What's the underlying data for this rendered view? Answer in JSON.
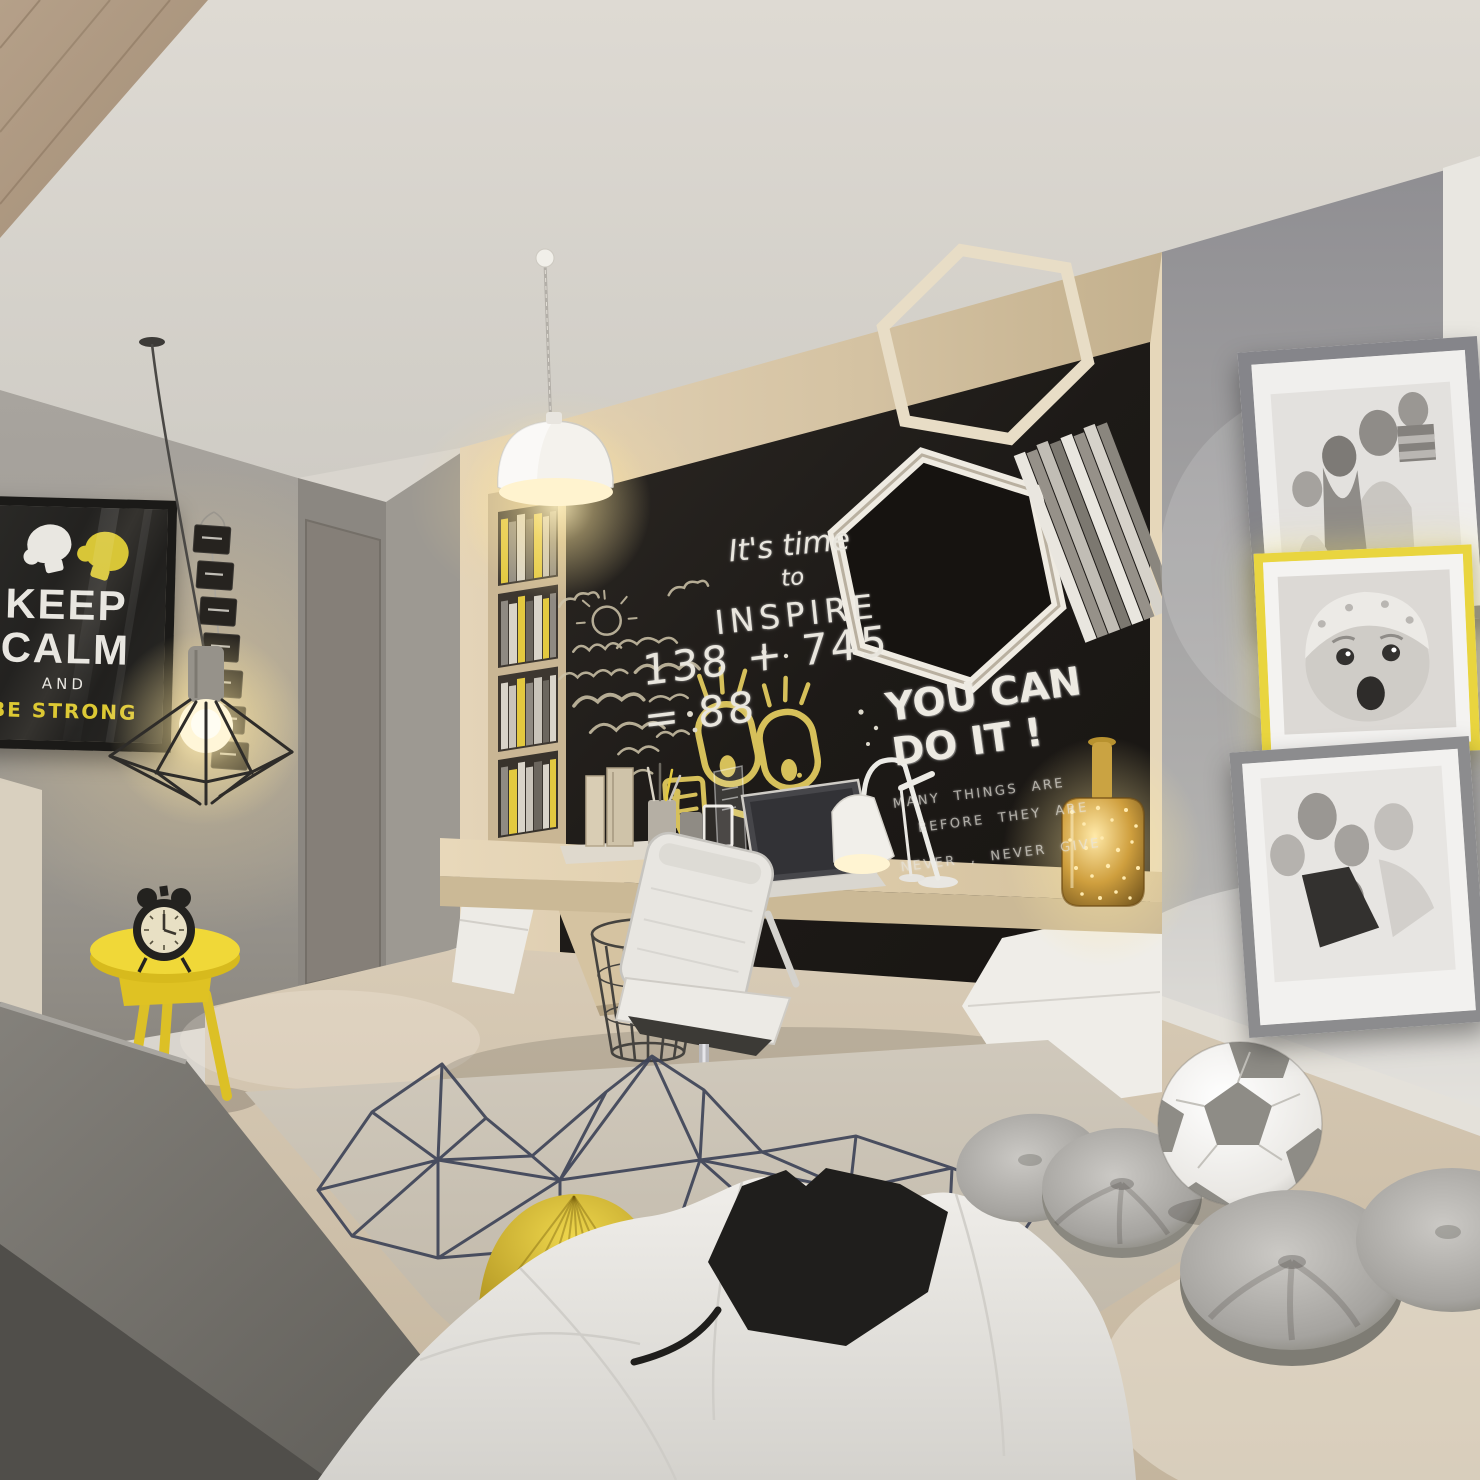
{
  "scene": {
    "description": "3D interior render: grey and yellow kids bedroom with black chalkboard study nook, desk, hexagon shelf and family photos"
  },
  "palette": {
    "accent_yellow": "#e9cf35",
    "chalk_white": "#e9e6de",
    "chalk_yellow": "#d6c05a",
    "chalkboard_black": "#24211e",
    "nook_wood": "#d8c6a8",
    "wall_grey": "#a09c97",
    "floor_wood": "#cfc3ae",
    "photo_frame_grey": "#87878b",
    "photo_frame_yellow": "#e9d53f"
  },
  "poster": {
    "word1": "KEEP",
    "word2": "CALM",
    "word3": "AND",
    "word4": "BE STRONG"
  },
  "chalkboard": {
    "quote_top_line1": "It's time",
    "quote_top_line2": "to",
    "quote_top_line3": "INSPIRE",
    "equation": "138 + 745 = 88",
    "quote_main": "YOU CAN DO IT !",
    "note_line1": "MANY THINGS ARE",
    "note_line2": "BEFORE THEY ARE",
    "note_line3": "NEVER , NEVER GIVE"
  },
  "hanging_tags": {
    "count": 7
  },
  "icons": {
    "chalk_wordcloud": "chalk-doodle-wordcloud-icon",
    "chalk_spongebob": "chalk-doodle-spongebob-icon",
    "boxing_gloves": "boxing-gloves-icon",
    "soccer_ball": "soccer-ball"
  }
}
